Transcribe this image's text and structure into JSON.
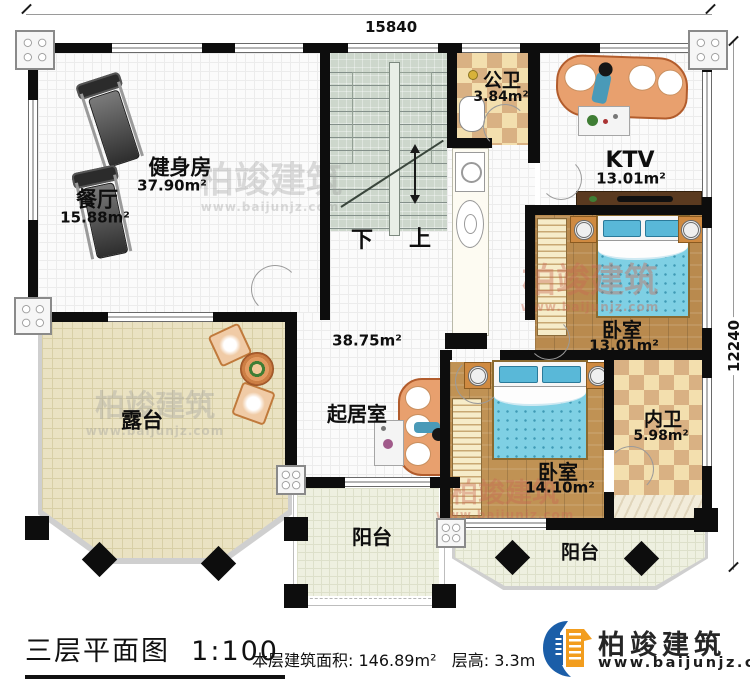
{
  "dimensions": {
    "width": "15840",
    "height": "12240"
  },
  "rooms": {
    "gym": {
      "name": "健身房",
      "area": "37.90m²"
    },
    "dining": {
      "name": "餐厅",
      "area": "15.88m²"
    },
    "public_bath": {
      "name": "公卫",
      "area": "3.84m²"
    },
    "ktv": {
      "name": "KTV",
      "area": "13.01m²"
    },
    "bedroom1": {
      "name": "卧室",
      "area": "13.01m²"
    },
    "ensuite": {
      "name": "内卫",
      "area": "5.98m²"
    },
    "bedroom2": {
      "name": "卧室",
      "area": "14.10m²"
    },
    "living": {
      "name": "起居室",
      "area": "38.75m²"
    },
    "terrace": {
      "name": "露台"
    },
    "balcony_left": {
      "name": "阳台"
    },
    "balcony_right": {
      "name": "阳台"
    }
  },
  "stairs": {
    "down": "下",
    "up": "上"
  },
  "watermark": {
    "brand": "柏竣建筑",
    "url": "www.baijunjz.com"
  },
  "titleblock": {
    "title": "三层平面图",
    "scale": "1:100",
    "area_label": "本层建筑面积:",
    "area_value": "146.89m²",
    "height_label": "层高:",
    "height_value": "3.3m"
  },
  "brand": {
    "name": "柏竣建筑",
    "url": "www.baijunjz.com"
  },
  "colors": {
    "wall": "#0d0d0d",
    "wood": "#b98a4e",
    "checker": "#e7c795",
    "terrace": "#eae2c2",
    "stair": "#cdd7cc",
    "bed": "#7fd0e4",
    "logo_blue": "#1b5ea8",
    "logo_orange": "#f29d1e",
    "watermark_red": "#c96a55"
  }
}
